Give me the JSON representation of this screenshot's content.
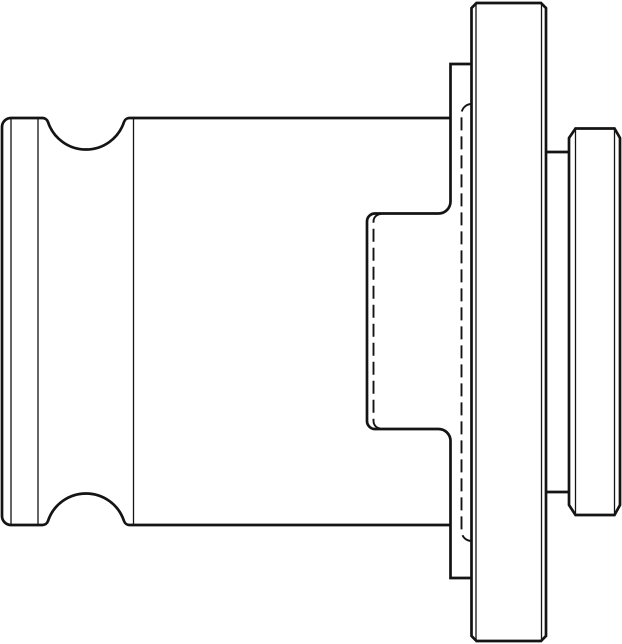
{
  "page": {
    "background": "#ffffff"
  },
  "drawing": {
    "kind": "technical-line-drawing",
    "subject": "tap-adapter-side-view",
    "canvas": {
      "width": 622,
      "height": 644
    },
    "ink": "#141414",
    "line_styles": {
      "thick": {
        "width": 2.7,
        "dash": ""
      },
      "thin": {
        "width": 1.3,
        "dash": ""
      },
      "hidden": {
        "width": 1.9,
        "dash": "13 6"
      }
    },
    "paths": [
      {
        "name": "shank-end-cap",
        "style": "thick",
        "d": "M 11 118 A 9 9 0 0 0 2 127 L 2 516 A 9 9 0 0 0 11 525"
      },
      {
        "name": "top-outline-with-groove",
        "style": "thick",
        "d": "M 11 118 L 42 118 A 6 6 0 0 1 48 122 A 40 40 0 0 0 124 122 A 6 6 0 0 1 130 118 L 450.5 118"
      },
      {
        "name": "bottom-outline-with-groove",
        "style": "thick",
        "d": "M 11 525 L 42 525 A 6 6 0 0 0 48 521 A 40 40 0 0 1 124 521 A 6 6 0 0 0 130 525 L 450.5 525"
      },
      {
        "name": "collar-upper-outline",
        "style": "thick",
        "d": "M 450.5 201.5 L 450.5 64 L 471.5 64"
      },
      {
        "name": "collar-lower-outline",
        "style": "thick",
        "d": "M 450.5 441 L 450.5 578 L 471.5 578"
      },
      {
        "name": "boss-outline",
        "style": "thick",
        "d": "M 450.5 201.5 A 12 12 0 0 1 438.5 213.5 L 375 213.5 A 8 8 0 0 0 367 221.5 L 367 421 A 8 8 0 0 0 375 429 L 438.5 429 A 12 12 0 0 1 450.5 441"
      },
      {
        "name": "flange-outline",
        "style": "thick",
        "d": "M 471.5 636 L 471.5 8 L 476.5 3 L 541 3 L 546 8 L 546 636 L 541 641 L 476.5 641 Z"
      },
      {
        "name": "neck-top-edge",
        "style": "thick",
        "d": "M 546 152 L 569 152"
      },
      {
        "name": "neck-bottom-edge",
        "style": "thick",
        "d": "M 546 492 L 569 492"
      },
      {
        "name": "end-cylinder-outline",
        "style": "thick",
        "d": "M 569 138 L 575.5 128.5 L 614.5 128.5 L 620 138 L 620 505 L 614.5 515 L 575.5 515 L 569 505 Z"
      },
      {
        "name": "shank-edge-line-outer",
        "style": "thin",
        "d": "M 11 118.5 L 11 524.5"
      },
      {
        "name": "shank-edge-line-inner",
        "style": "thin",
        "d": "M 38 118.5 L 38 524.5"
      },
      {
        "name": "body-shank-junction-line",
        "style": "thin",
        "d": "M 133.5 118.5 L 133.5 524.5"
      },
      {
        "name": "flange-left-corner-line",
        "style": "thin",
        "d": "M 476 4 L 476 640"
      },
      {
        "name": "flange-right-corner-line",
        "style": "thin",
        "d": "M 541.5 4 L 541.5 640"
      },
      {
        "name": "end-cylinder-left-chamfer-line",
        "style": "thin",
        "d": "M 575.5 129 L 575.5 514.5"
      },
      {
        "name": "end-cylinder-right-chamfer-line",
        "style": "thin",
        "d": "M 614.5 129 L 614.5 514.5"
      },
      {
        "name": "hidden-boss-bore-line",
        "style": "hidden",
        "d": "M 381 214 A 7.5 7.5 0 0 0 373.5 221.5 L 373.5 421 A 7.5 7.5 0 0 0 381 428.5"
      },
      {
        "name": "hidden-flange-recess-line",
        "style": "hidden",
        "d": "M 471.5 104 A 10 10 0 0 0 461.5 114 L 461.5 531 A 10 10 0 0 0 471.5 541"
      }
    ]
  }
}
